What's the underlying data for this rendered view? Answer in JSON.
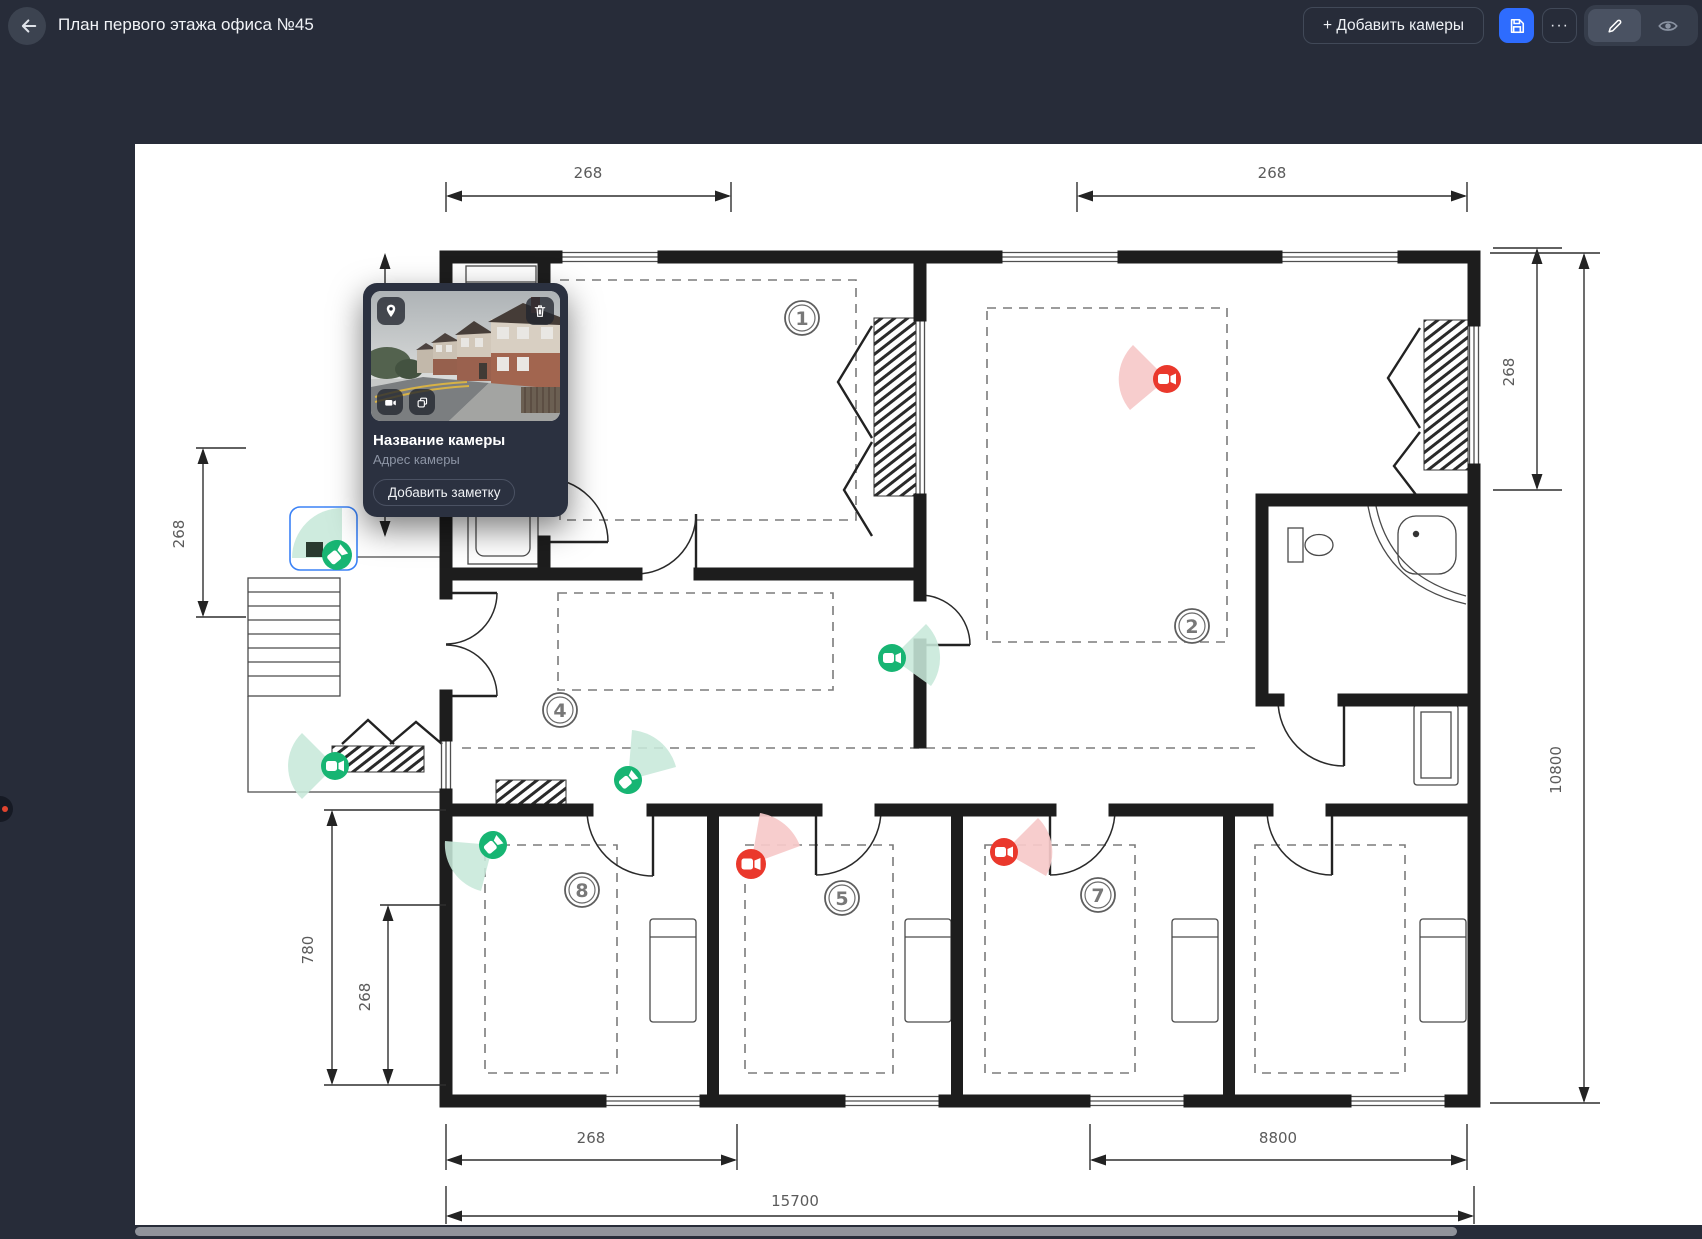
{
  "header": {
    "title": "План первого этажа офиса №45",
    "add_cameras_button": "+ Добавить камеры",
    "more_button": "···"
  },
  "camera_popup": {
    "name": "Название камеры",
    "address": "Адрес камеры",
    "add_note_button": "Добавить заметку"
  },
  "plan": {
    "dimensions": [
      {
        "id": "top-left-width",
        "value": "268"
      },
      {
        "id": "top-right-width",
        "value": "268"
      },
      {
        "id": "right-upper-height",
        "value": "268"
      },
      {
        "id": "right-total-height",
        "value": "10800"
      },
      {
        "id": "left-porch-height",
        "value": "268"
      },
      {
        "id": "left-wing-height",
        "value": "780"
      },
      {
        "id": "left-wing-inner-height",
        "value": "268"
      },
      {
        "id": "bottom-left-width",
        "value": "268"
      },
      {
        "id": "bottom-right-width",
        "value": "8800"
      },
      {
        "id": "bottom-total-width",
        "value": "15700"
      }
    ],
    "rooms": [
      {
        "number": "1"
      },
      {
        "number": "2"
      },
      {
        "number": "4"
      },
      {
        "number": "5"
      },
      {
        "number": "7"
      },
      {
        "number": "8"
      }
    ],
    "cameras": [
      {
        "id": "camera-1",
        "color": "#17b573",
        "selected": true
      },
      {
        "id": "camera-2",
        "color": "#17b573",
        "selected": false
      },
      {
        "id": "camera-3",
        "color": "#ea382c",
        "selected": false
      },
      {
        "id": "camera-4",
        "color": "#17b573",
        "selected": false
      },
      {
        "id": "camera-5",
        "color": "#17b573",
        "selected": false
      },
      {
        "id": "camera-6",
        "color": "#17b573",
        "selected": false
      },
      {
        "id": "camera-7",
        "color": "#ea382c",
        "selected": false
      },
      {
        "id": "camera-8",
        "color": "#ea382c",
        "selected": false
      }
    ]
  },
  "colors": {
    "background": "#272c39",
    "accent_blue": "#2e6cfe",
    "camera_green": "#17b573",
    "camera_red": "#ea382c",
    "selection_blue": "#3b82f6"
  }
}
